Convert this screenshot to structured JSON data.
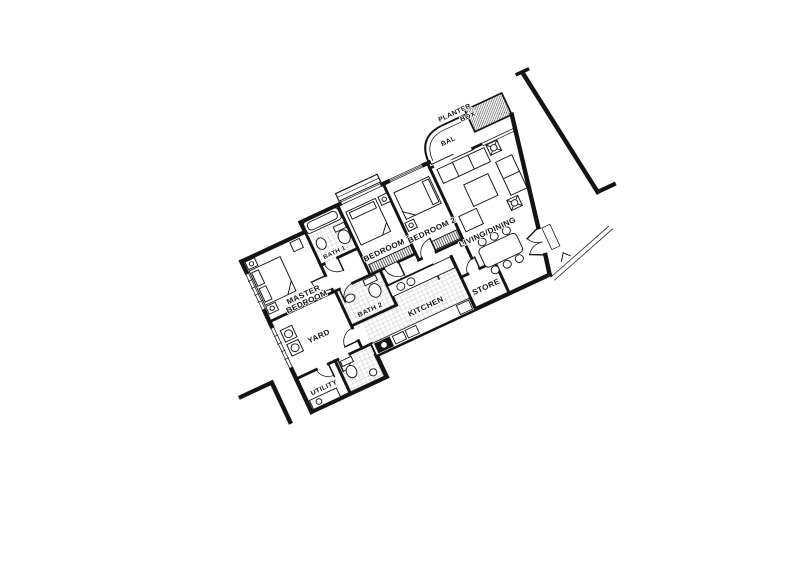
{
  "page": {
    "background": "#ffffff",
    "ink": "#141414",
    "tile_line": "#8c8c8c"
  },
  "floor_plan": {
    "type": "apartment-floor-plan",
    "rotation_deg": -25,
    "rooms": {
      "master_bedroom": {
        "line1": "MASTER",
        "line2": "BEDROOM"
      },
      "bath1": {
        "line1": "BATH 1"
      },
      "bedroom1": {
        "line1": "BEDROOM 1"
      },
      "bedroom2": {
        "line1": "BEDROOM 2"
      },
      "living_dining": {
        "line1": "LIVING/DINING"
      },
      "balcony": {
        "line1": "BAL"
      },
      "planter_box": {
        "line1": "PLANTER",
        "line2": "BOX"
      },
      "yard": {
        "line1": "YARD"
      },
      "utility": {
        "line1": "UTILITY"
      },
      "kitchen": {
        "line1": "KITCHEN"
      },
      "bath2": {
        "line1": "BATH 2"
      },
      "store": {
        "line1": "STORE"
      }
    }
  }
}
